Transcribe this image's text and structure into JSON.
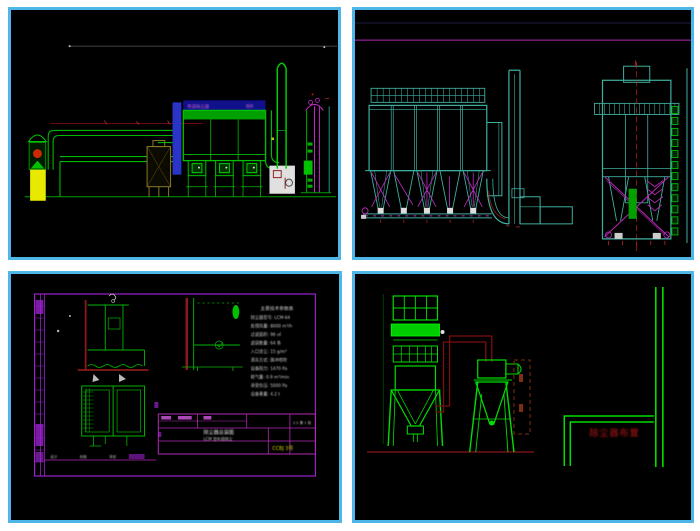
{
  "page": {
    "background": "#ffffff"
  },
  "colors": {
    "panel_border": "#4fb6e8",
    "panel_bg": "#000000",
    "cad_green": "#00b800",
    "cad_bright_green": "#00dd00",
    "cad_teal": "#3fae9e",
    "cad_magenta": "#c32cc3",
    "cad_purple": "#9922cc",
    "cad_dark_red": "#7a1010",
    "cad_red": "#bb2222",
    "cad_yellow": "#e8e800",
    "cad_blue_band": "#2a35c8",
    "cad_dark_blue": "#10108a",
    "cad_white": "#e0e0e0"
  },
  "panels": [
    {
      "name": "process-line-elevation"
    },
    {
      "name": "baghouse-front-and-side-elevations"
    },
    {
      "name": "detail-sheet-with-title-block"
    },
    {
      "name": "dust-collector-and-stack-elevation"
    }
  ],
  "top_left": {
    "header_label": "布袋除尘器",
    "header_label_right": "图例"
  },
  "bottom_left": {
    "spec_title": "主要技术参数表",
    "spec_lines": [
      "除尘器型号: LCM-64",
      "处理风量: 8000 m³/h",
      "过滤面积: 96 ㎡",
      "滤袋数量: 64 条",
      "入口含尘: 15 g/m³",
      "清灰方式: 脉冲喷吹",
      "设备阻力: 1470 Pa",
      "耗气量: 0.9 m³/min",
      "承受负压: 5000 Pa",
      "设备重量: 4.2 t"
    ],
    "title_block": {
      "field_design": "设计",
      "field_check": "校核",
      "field_approve": "审定",
      "drawing_name": "除尘器总装图",
      "drawing_sub": "LCM 型布袋除尘",
      "sheet_info": "1:1 第 1 张",
      "stamp": "CCBJ 3号"
    }
  },
  "bottom_right": {
    "red_label": "除尘器布置"
  }
}
